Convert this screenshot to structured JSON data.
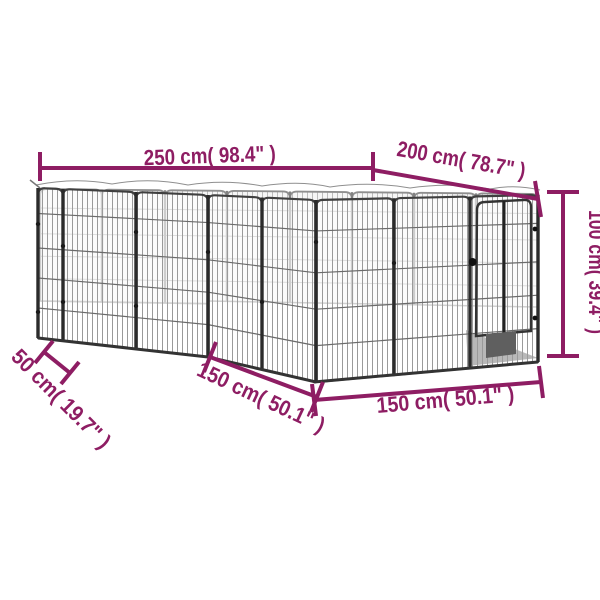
{
  "diagram": {
    "type": "product-dimension-diagram",
    "subject": "dog-playpen-wire-panels",
    "background_color": "#ffffff",
    "accent_color": "#8E1D63",
    "line_art_color": "#4a4a4a",
    "dimensions": [
      {
        "id": "width-left",
        "label": "250 cm( 98.4\" )"
      },
      {
        "id": "width-right",
        "label": "200 cm( 78.7\" )"
      },
      {
        "id": "height-right",
        "label": "100 cm( 39.4\" )"
      },
      {
        "id": "depth-left",
        "label": "50 cm( 19.7\" )"
      },
      {
        "id": "depth-middle",
        "label": "150 cm( 50.1\" )"
      },
      {
        "id": "width-front",
        "label": "150 cm( 50.1\" )"
      }
    ]
  }
}
